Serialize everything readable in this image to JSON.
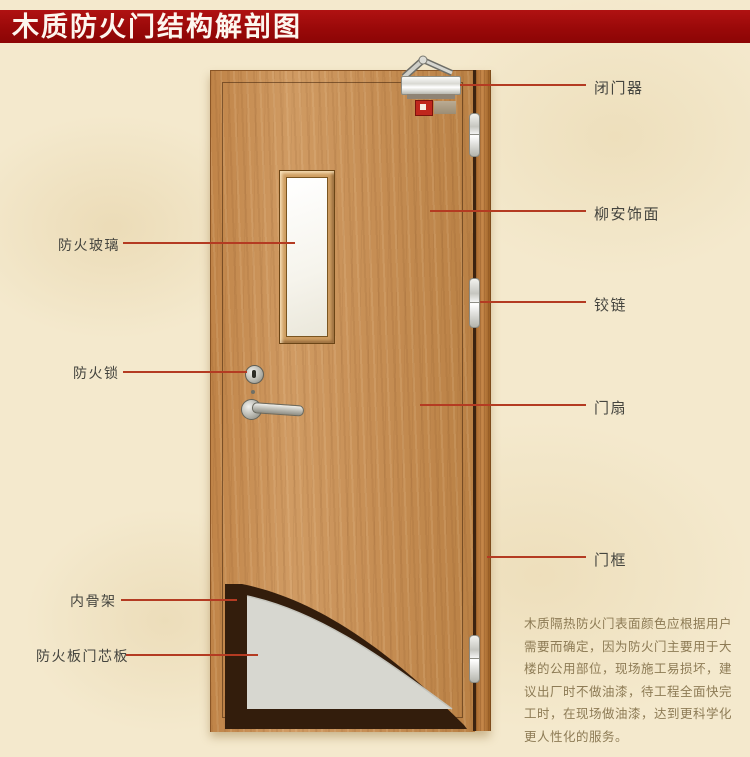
{
  "title": {
    "text": "木质防火门结构解剖图"
  },
  "colors": {
    "banner_red": "#9a0909",
    "background_cream": "#f4e9cd",
    "pointer_line_red": "#b43b22",
    "door_wood": "#c68e54",
    "frame_wood": "#a96a2e",
    "core_gray": "#d7d7d0",
    "skeleton_dark": "#331d0c",
    "glass_white": "#f6f4ec"
  },
  "labels": {
    "left": [
      {
        "id": "fire-glass",
        "text": "防火玻璃"
      },
      {
        "id": "fire-lock",
        "text": "防火锁"
      },
      {
        "id": "inner-skeleton",
        "text": "内骨架"
      },
      {
        "id": "fire-board-core",
        "text": "防火板门芯板"
      }
    ],
    "right": [
      {
        "id": "door-closer",
        "text": "闭门器"
      },
      {
        "id": "lauan-veneer",
        "text": "柳安饰面"
      },
      {
        "id": "hinge",
        "text": "铰链"
      },
      {
        "id": "door-leaf",
        "text": "门扇"
      },
      {
        "id": "door-frame",
        "text": "门框"
      }
    ]
  },
  "description": {
    "lines": [
      "木质隔热防火门表面颜色应根据用户",
      "需要而确定，因为防火门主要用于大",
      "楼的公用部位，现场施工易损坏，建",
      "议出厂时不做油漆，待工程全面快完",
      "工时，在现场做油漆，达到更科学化",
      "更人性化的服务。"
    ]
  }
}
